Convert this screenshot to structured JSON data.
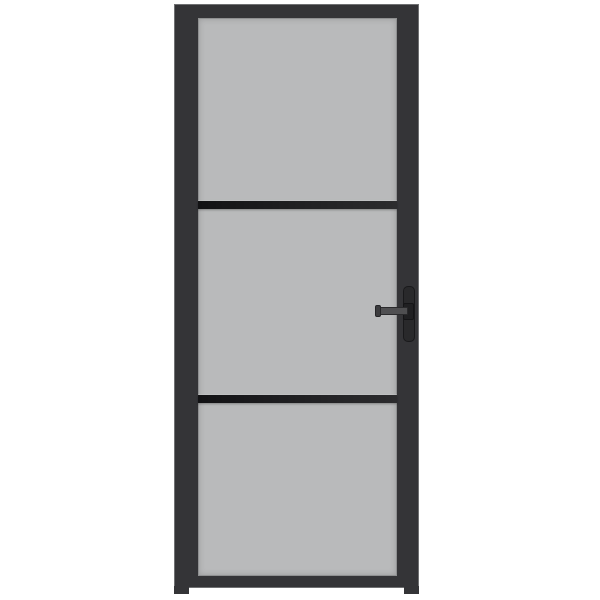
{
  "scene": {
    "subject": "Interior door with black metal frame, three frosted grey glass panels, two horizontal glazing bars and a black lever handle with backplate on the right side, shown on a plain white background",
    "panel_count": 3,
    "handle_side": "right",
    "colors": {
      "background": "#ffffff",
      "frame": "#343437",
      "frame-edge": "#6f7072",
      "glass": "#b9babb",
      "glass-bevel": "#8f9091",
      "divider": "#1c1c1e",
      "backplate": "#29292b",
      "lever": "#4f4f51",
      "lever-edge": "#2a2a2c"
    }
  }
}
